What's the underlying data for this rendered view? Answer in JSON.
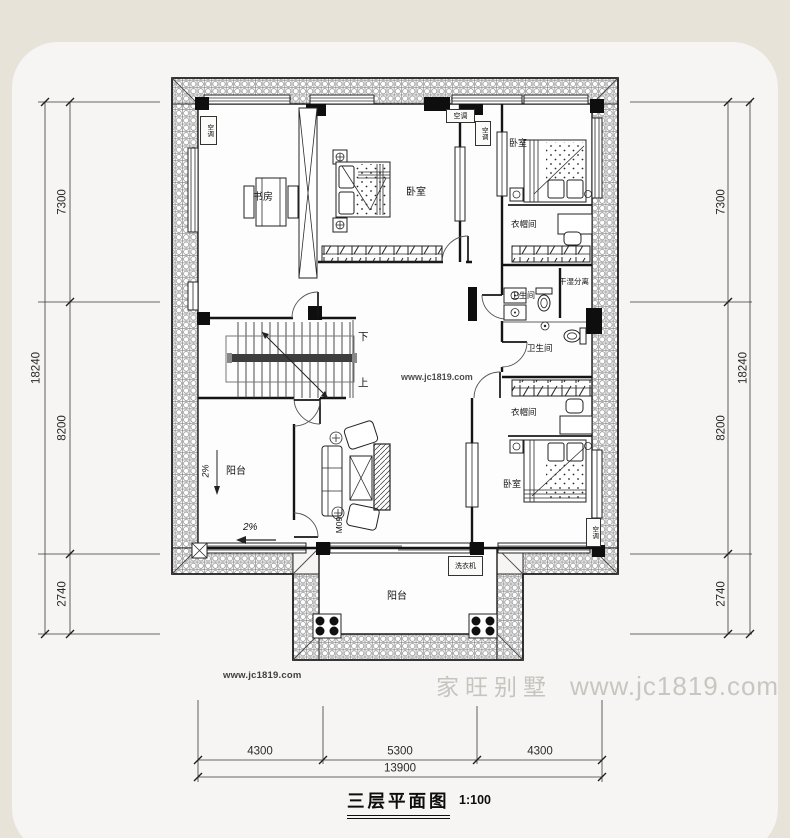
{
  "colors": {
    "background": "#e7e3d9",
    "card": "#f6f5f3",
    "line": "#1a1a1a",
    "watermark_gray": "#c9c6c1"
  },
  "plan": {
    "rooms": {
      "study": "书房",
      "bedroom_top": "卧室",
      "bedroom_right_top": "卧室",
      "cloakroom_top": "衣帽间",
      "dry_wet_separation": "干湿分离",
      "bathroom_small": "卫生间",
      "bathroom_large": "卫生间",
      "cloakroom_bottom": "衣帽间",
      "bedroom_right_bottom": "卧室",
      "balcony_left": "阳台",
      "balcony_bottom": "阳台"
    },
    "annotations": {
      "ac_unit": "空调",
      "washing_machine": "洗衣机",
      "stairs_down": "下",
      "stairs_up": "上",
      "door_code": "M09",
      "slope_left": "2%",
      "slope_bottom": "2%"
    }
  },
  "dimensions": {
    "left": {
      "segments": [
        "7300",
        "8200",
        "2740"
      ],
      "total": "18240"
    },
    "right": {
      "segments": [
        "7300",
        "8200",
        "2740"
      ],
      "total": "18240"
    },
    "bottom": {
      "segments": [
        "4300",
        "5300",
        "4300"
      ],
      "total": "13900"
    }
  },
  "title": {
    "name": "三层平面图",
    "scale": "1:100"
  },
  "watermarks": {
    "plan_center": "www.jc1819.com",
    "bottom_left": "www.jc1819.com",
    "brand": "家旺别墅",
    "brand_site": "www.jc1819.com"
  }
}
